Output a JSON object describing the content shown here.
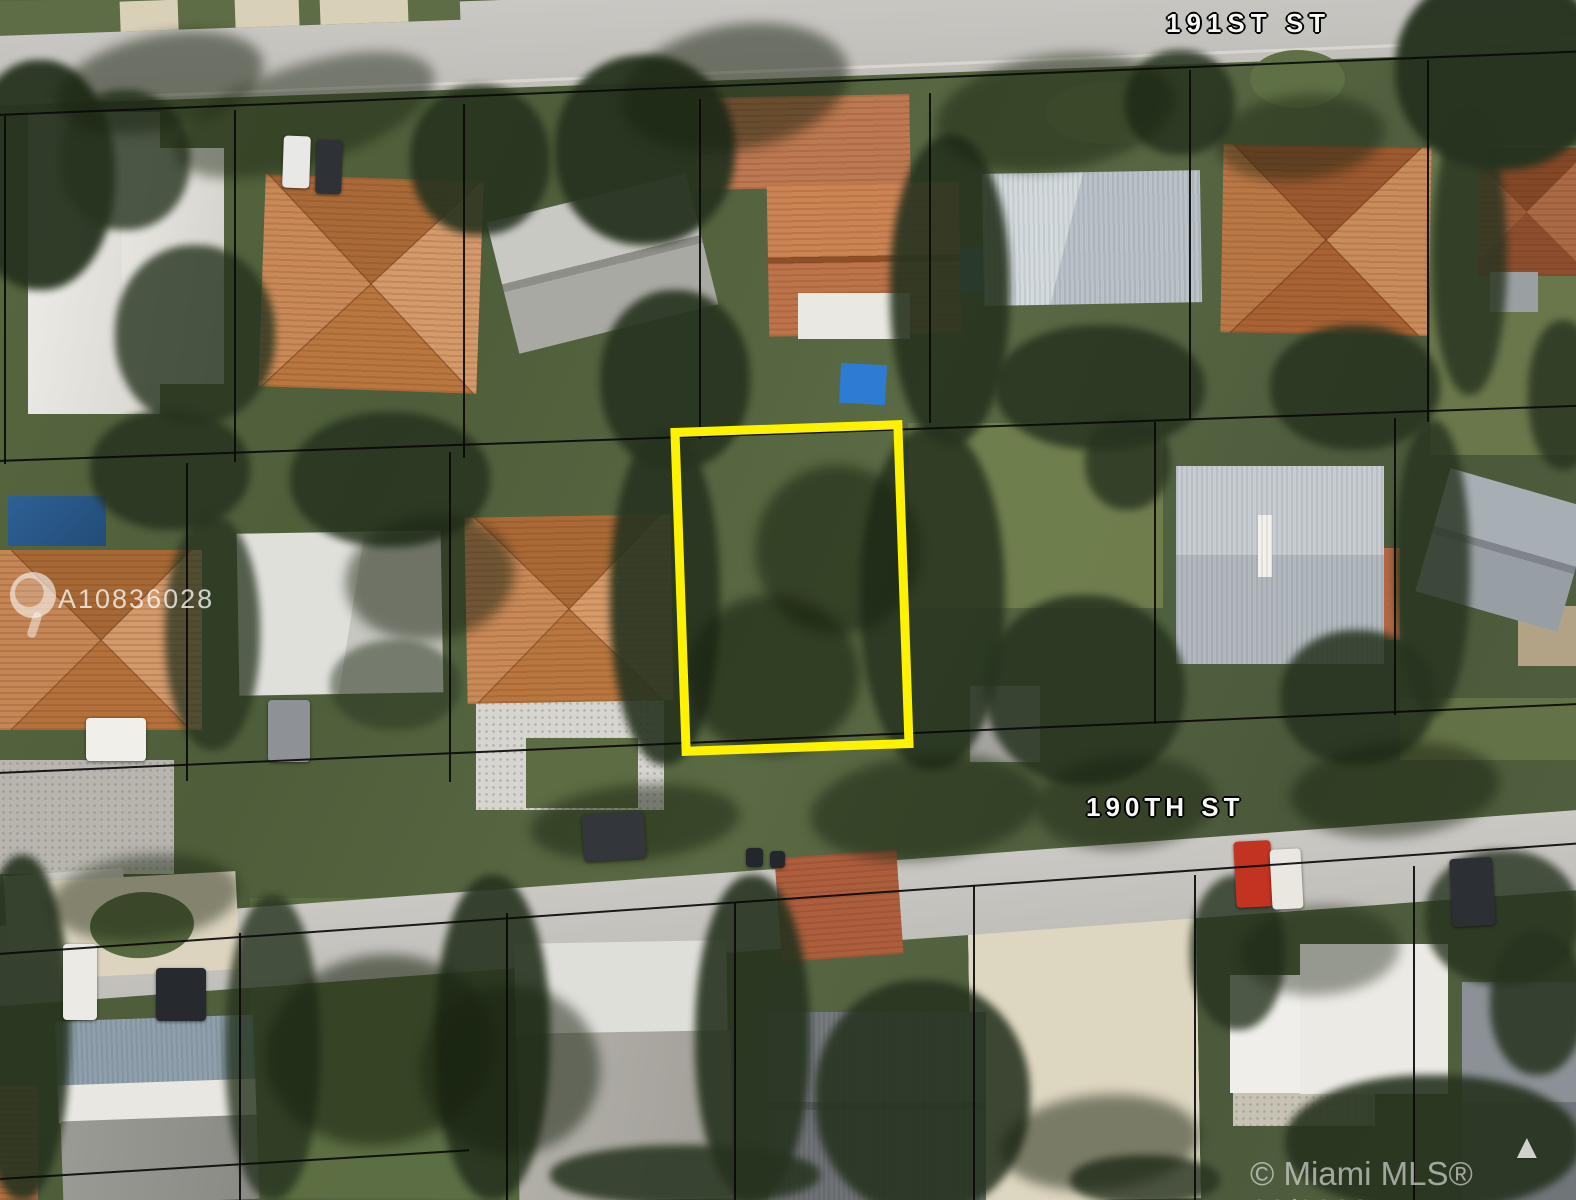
{
  "scene": {
    "street_labels": [
      {
        "id": "191st",
        "label": "191ST ST"
      },
      {
        "id": "190th",
        "label": "190TH ST"
      }
    ],
    "watermarks": {
      "listing_id": "A10836028",
      "copyright": "© Miami MLS® 03/2020"
    },
    "highlight": {
      "color": "#FFF200"
    },
    "icons": {
      "mls_logo": "mls-logo-icon",
      "north_arrow_glyph": "▲"
    }
  }
}
